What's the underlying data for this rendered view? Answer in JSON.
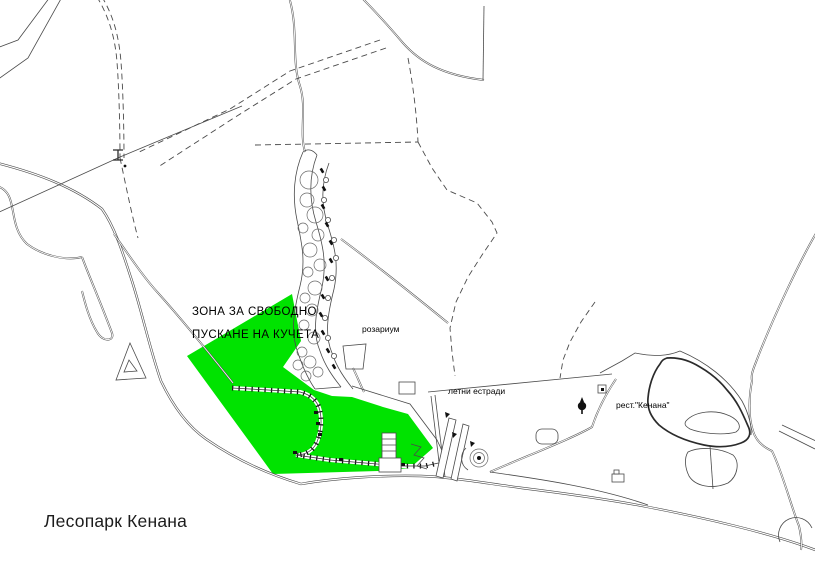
{
  "map": {
    "title": "Лесопарк Кенана",
    "dog_zone": {
      "label_line1": "ЗОНА ЗА СВОБОДНО",
      "label_line2": "ПУСКАНЕ НА КУЧЕТА"
    },
    "labels": {
      "rosarium": "розариум",
      "summer_stages": "летни естради",
      "restaurant": "рест.\"Кенана\""
    },
    "colors": {
      "dog_zone_fill": "#00E300",
      "line": "#4a4a4a",
      "background": "#ffffff",
      "text": "#000000"
    }
  }
}
